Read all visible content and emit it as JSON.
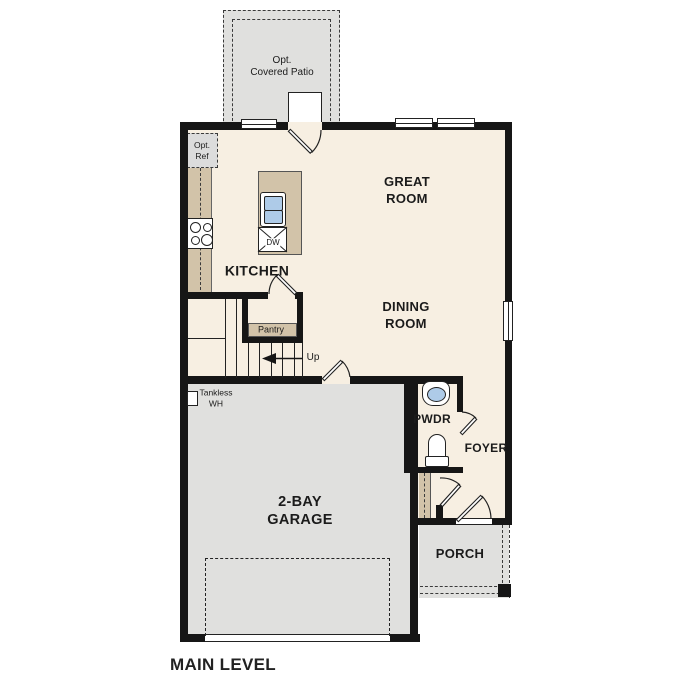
{
  "plan": {
    "title": "MAIN LEVEL",
    "labels": {
      "patio": "Opt.\nCovered Patio",
      "opt_ref": "Opt.\nRef",
      "great_room": "GREAT\nROOM",
      "kitchen": "KITCHEN",
      "dining_room": "DINING\nROOM",
      "pantry": "Pantry",
      "up": "Up",
      "tankless_wh": "Tankless\nWH",
      "pwdr": "PWDR",
      "foyer": "FOYER",
      "garage": "2-BAY\nGARAGE",
      "porch": "PORCH",
      "dw": "DW"
    },
    "colors": {
      "wall": "#161616",
      "interior": "#f7efe2",
      "exterior_space": "#e0e0de",
      "counter": "#d2c3a9",
      "sink": "#aecbe8"
    }
  }
}
